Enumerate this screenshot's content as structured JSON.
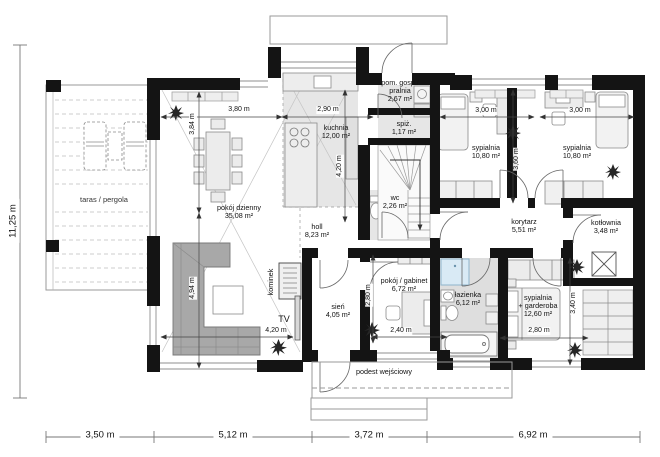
{
  "plan": {
    "rooms": [
      {
        "name": "pokój dzienny",
        "area": "35,08 m²"
      },
      {
        "name": "kuchnia",
        "area": "12,00 m²"
      },
      {
        "name": "holl",
        "area": "8,23 m²"
      },
      {
        "name": "pom. gosp./",
        "name2": "pralnia",
        "area": "2,67 m²"
      },
      {
        "name": "spiż.",
        "area": "1,17 m²"
      },
      {
        "name": "wc",
        "area": "2,26 m²"
      },
      {
        "name": "sypialnia",
        "area": "10,80 m²"
      },
      {
        "name": "sypialnia",
        "area": "10,80 m²"
      },
      {
        "name": "korytarz",
        "area": "5,51 m²"
      },
      {
        "name": "kotłownia",
        "area": "3,48 m²"
      },
      {
        "name": "sień",
        "area": "4,05 m²"
      },
      {
        "name": "pokój / gabinet",
        "area": "6,72 m²"
      },
      {
        "name": "łazienka",
        "area": "6,12 m²"
      },
      {
        "name": "sypialnia",
        "name2": "+ garderoba",
        "area": "12,60 m²"
      },
      {
        "name": "taras / pergola",
        "area": ""
      }
    ],
    "features": {
      "fireplace": "kominek",
      "tv": "TV",
      "entry": "podest wejściowy"
    },
    "dims": {
      "overall_height": "11,25 m",
      "bottom": [
        "3,50 m",
        "5,12 m",
        "3,72 m",
        "6,92 m"
      ],
      "interior": [
        "3,80 m",
        "2,90 m",
        "3,84 m",
        "4,20 m",
        "3,00 m",
        "3,00 m",
        "3,60 m",
        "4,94 m",
        "4,20 m",
        "2,80 m",
        "2,40 m",
        "2,80 m",
        "3,40 m"
      ]
    },
    "colors": {
      "wall": "#141414",
      "floor": "#e6e6e6",
      "sofa": "#a8a8a8",
      "shower": "#d9eaf5"
    }
  }
}
